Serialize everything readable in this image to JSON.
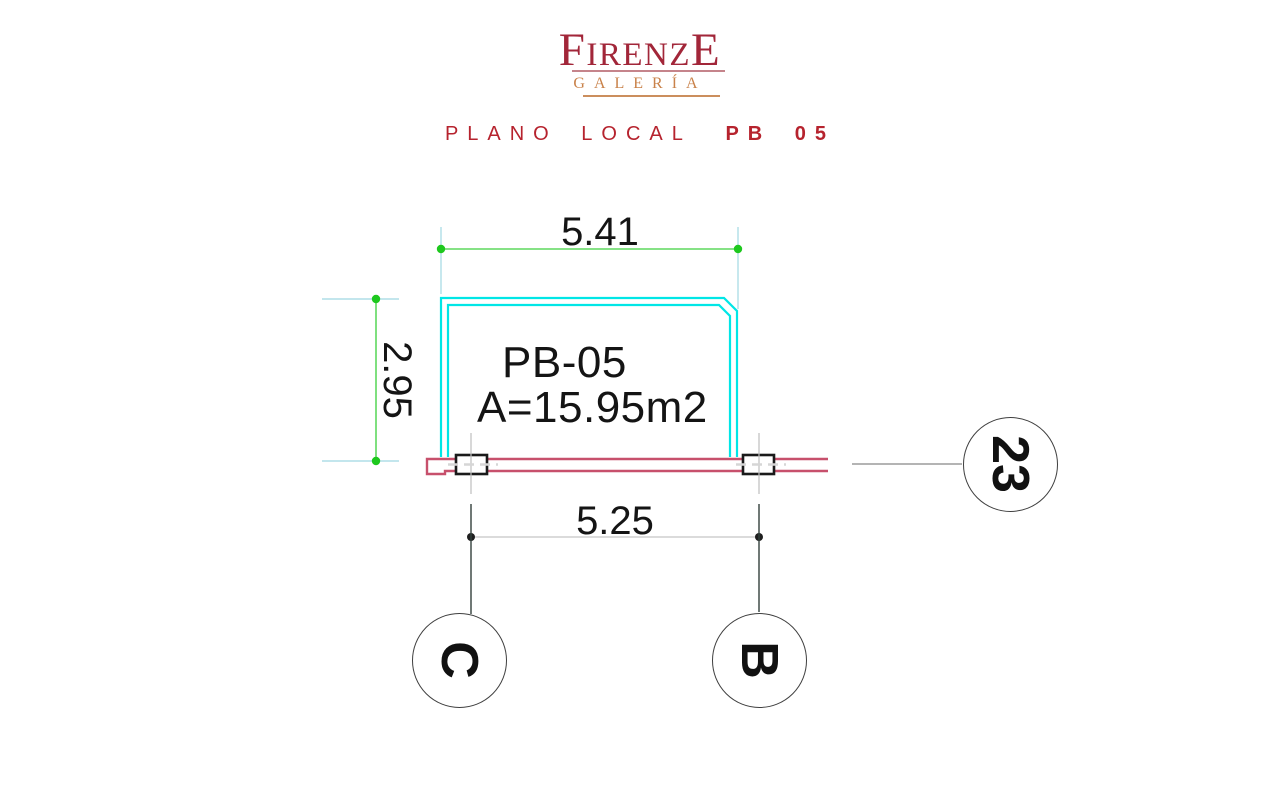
{
  "brand": {
    "wordmark_first": "F",
    "wordmark_middle": "IRENZ",
    "wordmark_last": "E",
    "subtitle": "GALERÍA",
    "wordmark_color": "#A22639",
    "subtitle_color": "#C9824A"
  },
  "page_title": {
    "prefix": "PLANO LOCAL",
    "code": "PB 05",
    "color": "#B6232E"
  },
  "plan": {
    "unit": {
      "code": "PB-05",
      "area": "A=15.95m2"
    },
    "dimensions": {
      "width_top": "5.41",
      "height_left": "2.95",
      "axis_span_bottom": "5.25"
    },
    "grid_axes": [
      {
        "id": "C"
      },
      {
        "id": "B"
      },
      {
        "id": "23"
      }
    ],
    "colors": {
      "storefront_glass": "#00E6E6",
      "wall": "#C7506C",
      "dimension_line_green": "#5FD95F",
      "dimension_dot_green": "#1EC81E",
      "extension_line": "#AFDEE7",
      "dimension_line_gray": "#CFCFCF",
      "dimension_dot_black": "#1F1F1F",
      "text": "#141414"
    }
  }
}
